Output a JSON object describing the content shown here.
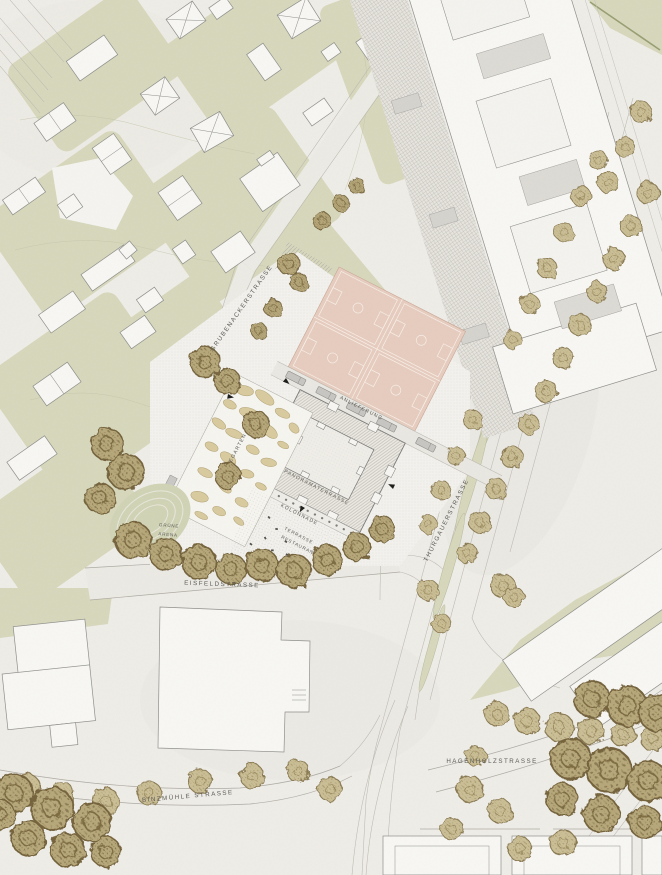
{
  "plan": {
    "labels": {
      "grubenackerstrasse": "GRUBENACKERSTRASSE",
      "anlieferung": "ANLIEFERUNG",
      "panoramaterrasse": "PANORAMATERRASSE",
      "kolonnade": "KOLONNADE",
      "terrasse": "TERRASSE",
      "restaurant": "RESTAURANT",
      "gemuesegarten": "GEMÜSEGARTEN",
      "gruene": "GRÜNE",
      "arena": "ARENA",
      "eisfeldstrasse": "EISFELDSTRASSE",
      "thurgauerstrasse": "THURGAUERSTRASSE",
      "hagenholzstrasse": "HAGENHOLZSTRASSE",
      "binzmuehlestrasse": "BINZMÜHLE STRASSE"
    },
    "colors": {
      "paper": "#efede8",
      "vegetation_green": "#d7d8bc",
      "sports_court_pink": "#e7cdbf",
      "tree_canopy": "#c3b68a",
      "tree_outline": "#8a7a52",
      "building_fill": "#f8f7f4",
      "building_outline": "#8f8f8b",
      "label_text": "#5c5a55"
    }
  }
}
